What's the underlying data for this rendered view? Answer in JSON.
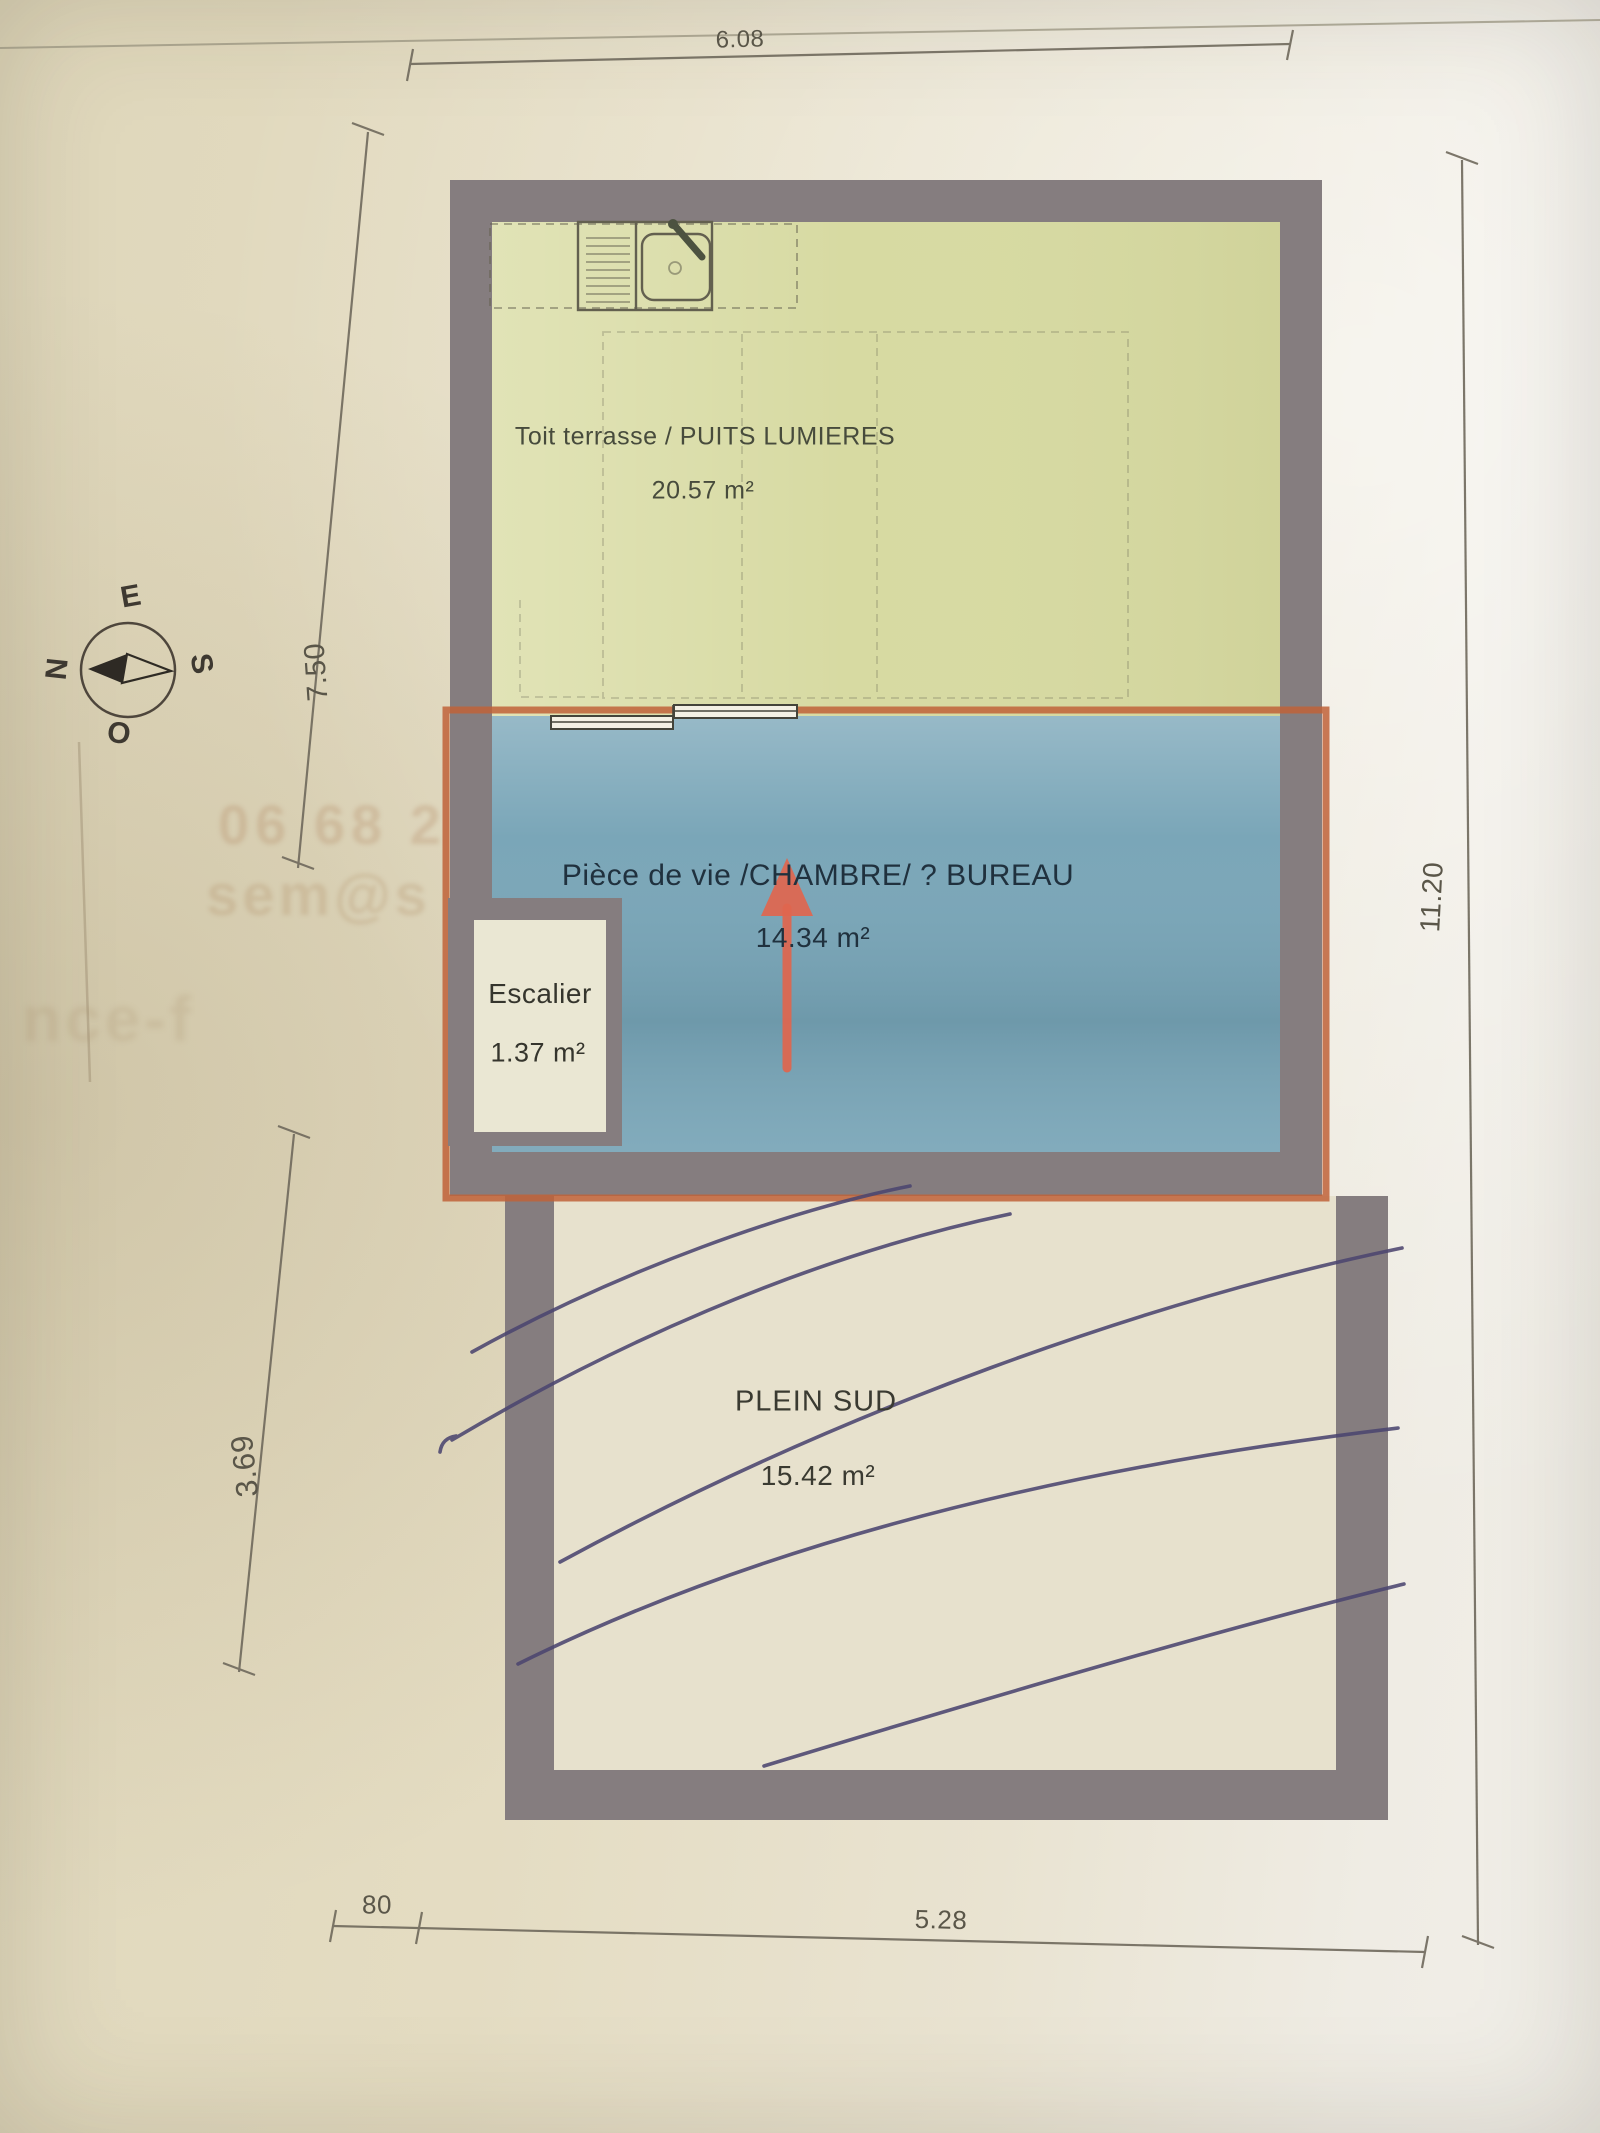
{
  "plan": {
    "rooms": {
      "terrace": {
        "name": "Toit terrasse / PUITS LUMIERES",
        "area": "20.57 m²"
      },
      "living": {
        "name": "Pièce de vie /CHAMBRE/ ? BUREAU",
        "area": "14.34 m²"
      },
      "stairs": {
        "name": "Escalier",
        "area": "1.37 m²"
      },
      "south_terrace": {
        "name": "PLEIN SUD",
        "area": "15.42 m²"
      }
    },
    "dimensions": {
      "top_width": "6.08",
      "upper_left_height": "7.50",
      "lower_left_height": "3.69",
      "right_height": "11.20",
      "bottom_offset": "80",
      "bottom_width": "5.28"
    },
    "compass": {
      "north": "N",
      "east": "E",
      "south": "S",
      "west": "O"
    },
    "colors": {
      "wall": "#857d7f",
      "terrace_fill": "#d7daa2",
      "living_fill": "#7aa6b8",
      "stairs_fill": "#eae7d3",
      "highlight_outline": "#c06138",
      "arrow": "#e0664e",
      "pen_ink": "#4c4670",
      "plan_line": "#63604f",
      "paper": "#e7e1cd"
    }
  },
  "bleedthrough": {
    "line1": "06 68 2",
    "line2": "sem@s",
    "line3": "nce-f"
  }
}
